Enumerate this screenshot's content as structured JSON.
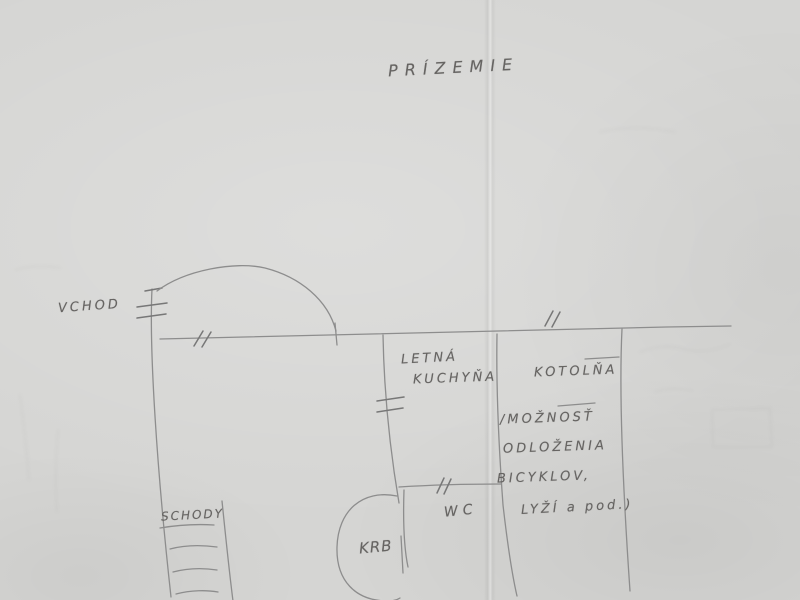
{
  "sketch": {
    "title": "PRÍZEMIE",
    "labels": {
      "entrance": "VCHOD",
      "summer_kitchen": [
        "LETNÁ",
        "KUCHYŇA"
      ],
      "boiler_room": "KOTOLŇA",
      "storage_note": [
        "/MOŽNOSŤ",
        "ODLOŽENIA",
        "BICYKLOV,",
        "LYŽÍ a pod.)"
      ],
      "stairs": "SCHODY",
      "toilet": "WC",
      "fireplace": "KRB"
    },
    "colors": {
      "paper": "#d5d5d3",
      "pencil_line": "#8d8d8d",
      "pencil_text": "#666462"
    }
  }
}
